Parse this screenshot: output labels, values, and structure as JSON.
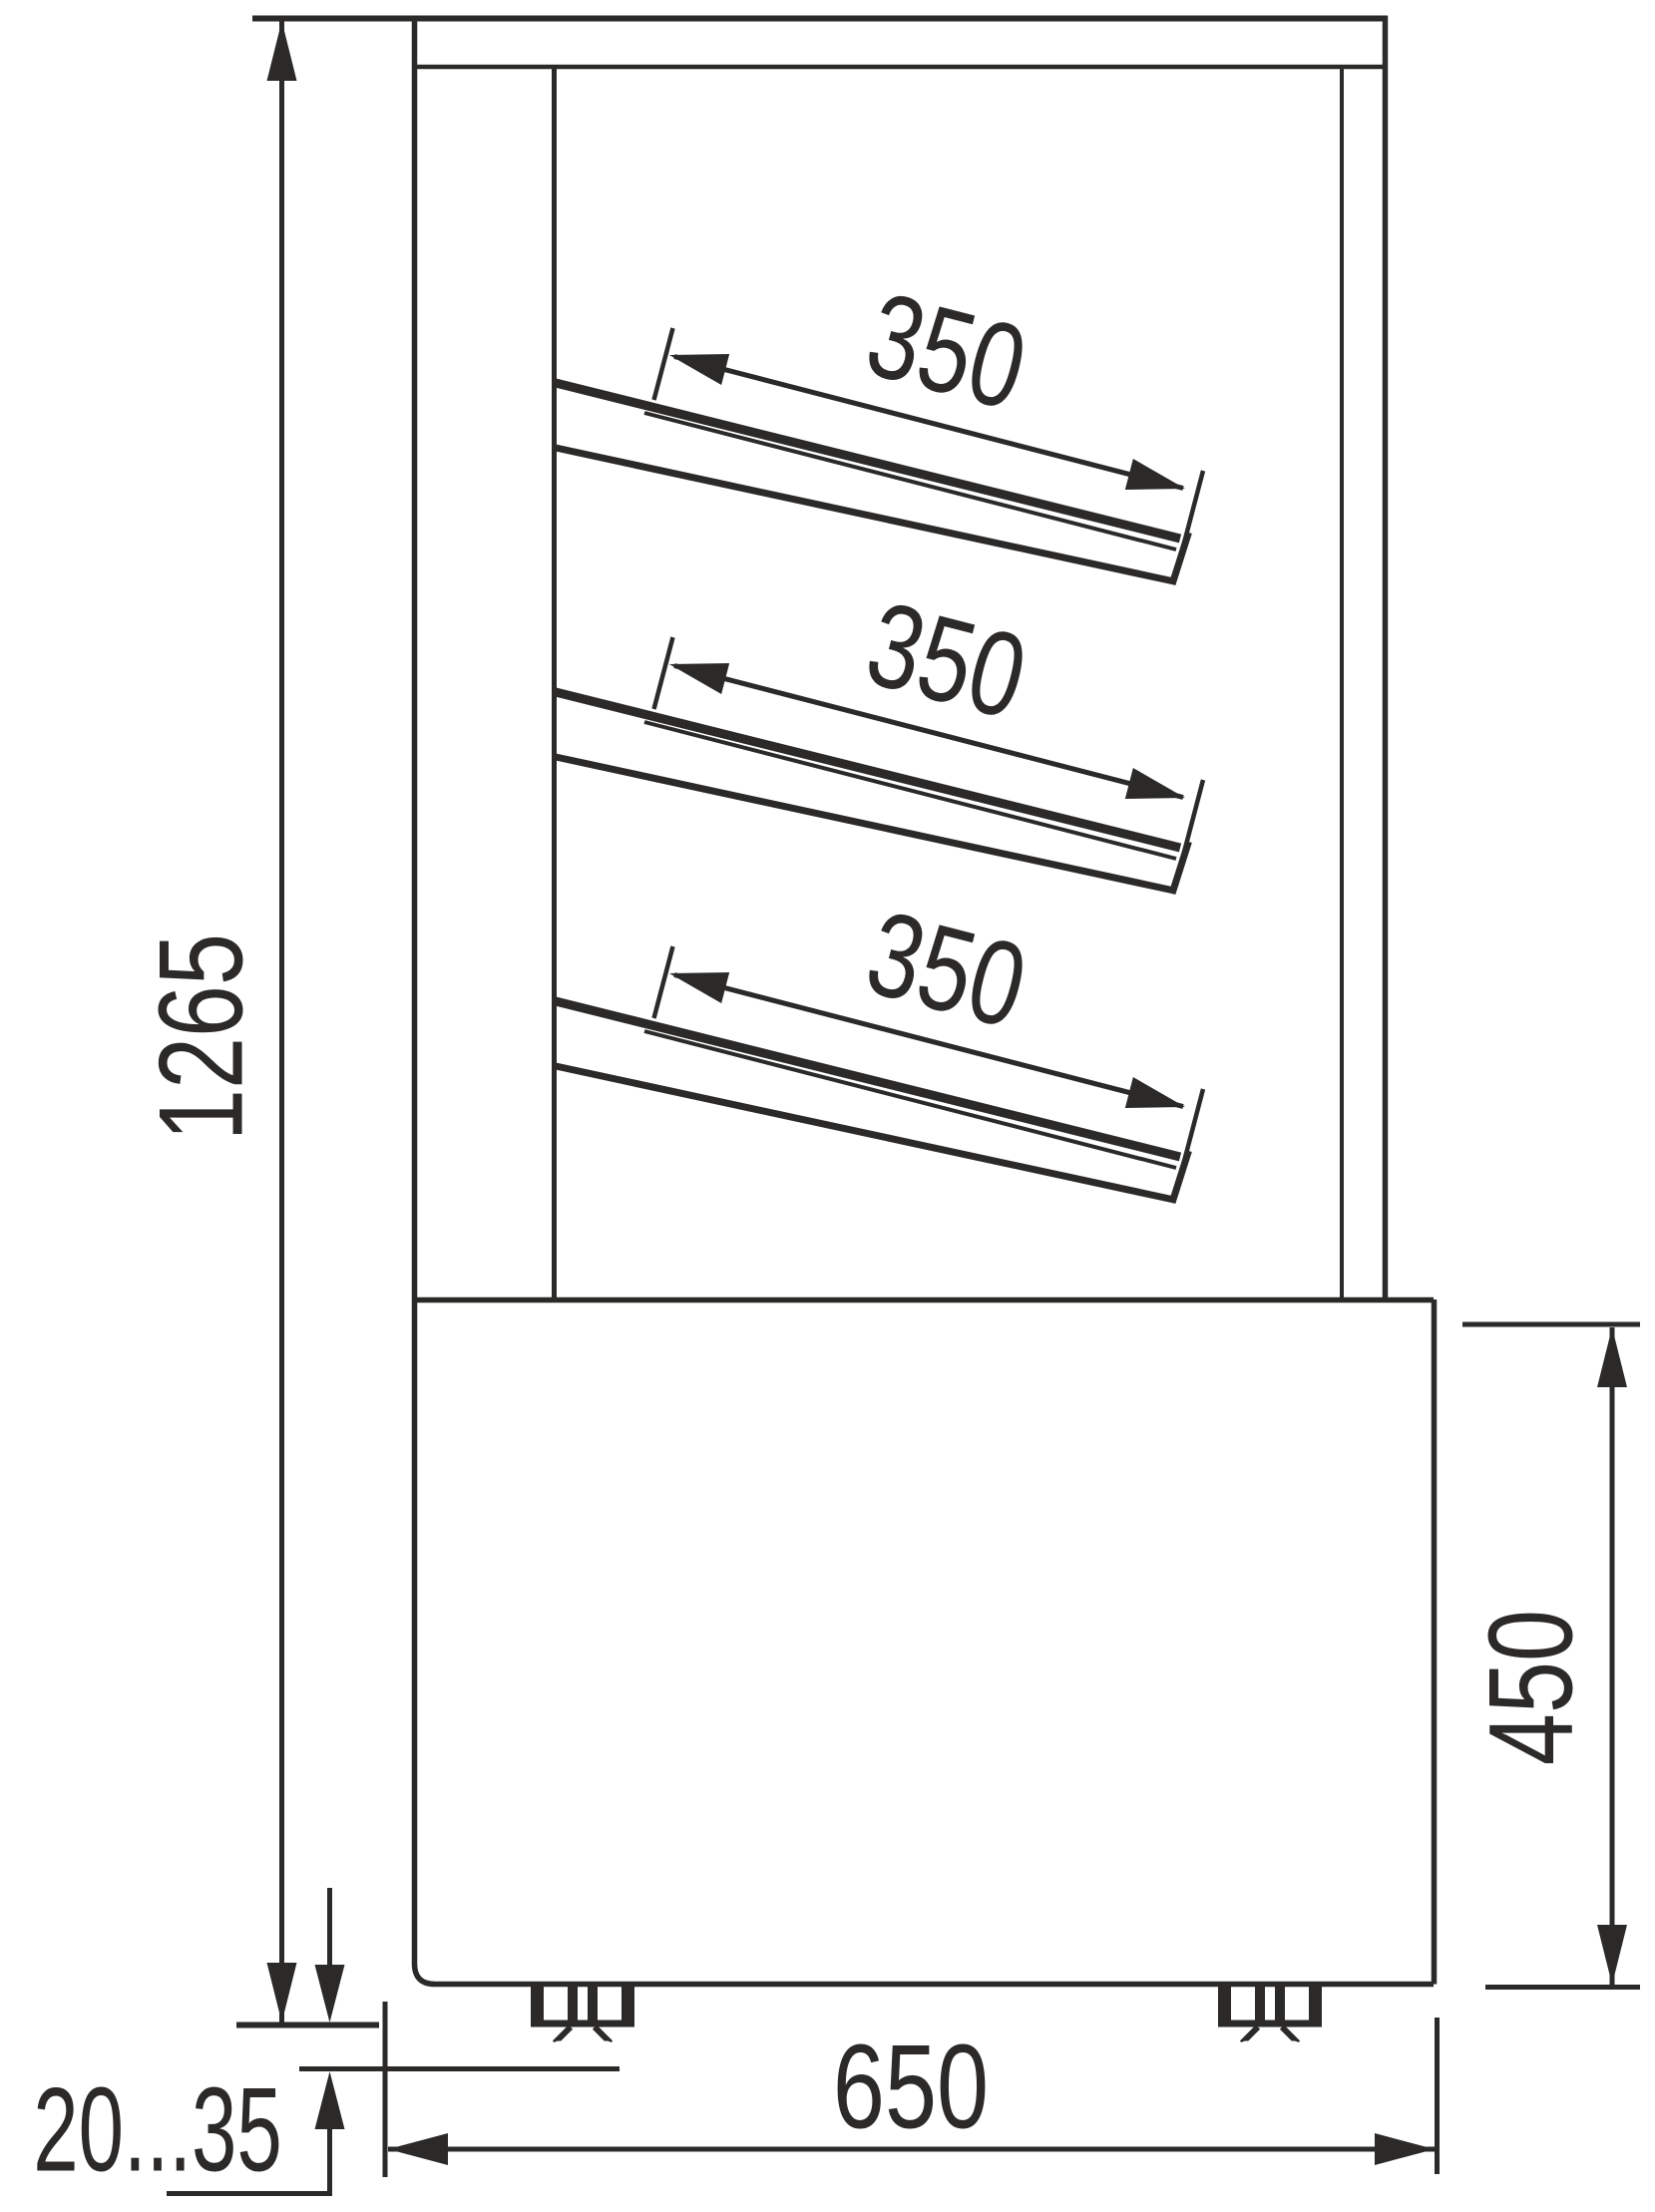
{
  "diagram": {
    "kind": "technical drawing - refrigerated display case, side view with dimensions",
    "background": "#ffffff",
    "line_color": "#2b2a29",
    "labels": {
      "overall_height": "1265",
      "shelf_top_depth": "350",
      "shelf_middle_depth": "350",
      "shelf_bottom_depth": "350",
      "base_height": "450",
      "base_depth": "650",
      "foot_height_range": "20...35"
    }
  }
}
